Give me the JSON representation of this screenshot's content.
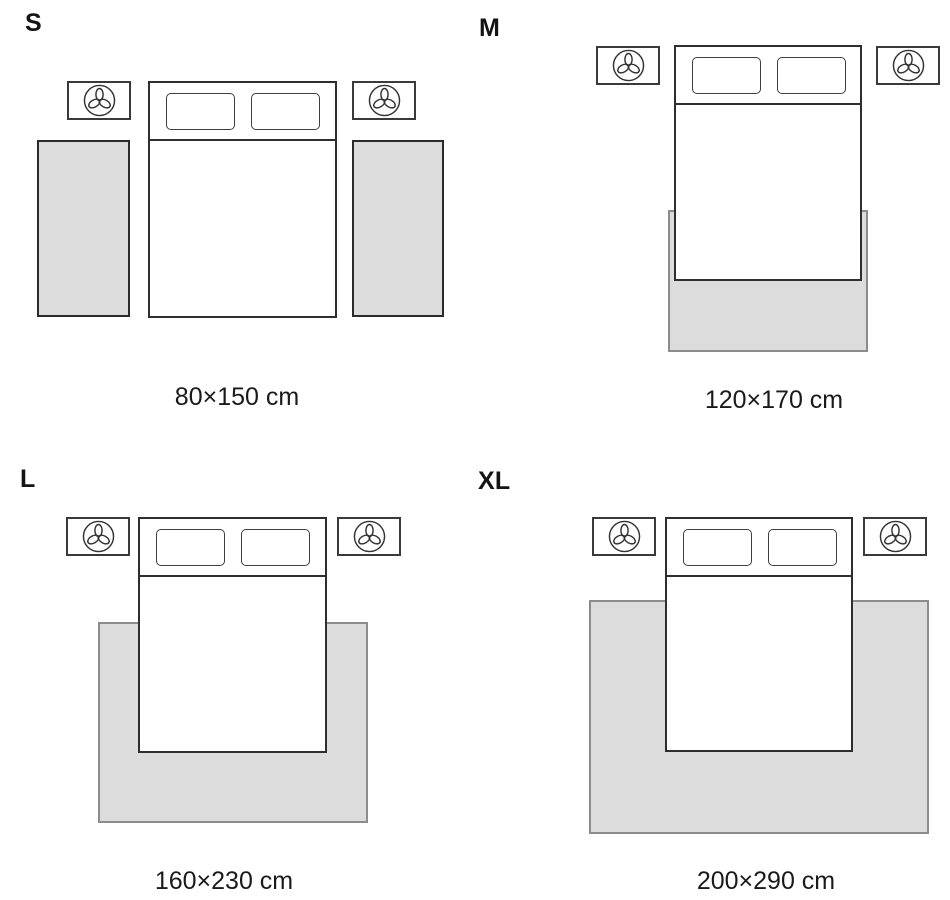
{
  "figure": "rug-size-guide",
  "sizes": [
    {
      "label": "S",
      "dimensions": "80×150 cm",
      "rug_placement": "two runner rugs, one on each side of the bed"
    },
    {
      "label": "M",
      "dimensions": "120×170 cm",
      "rug_placement": "rug under the foot half of the bed"
    },
    {
      "label": "L",
      "dimensions": "160×230 cm",
      "rug_placement": "rug under the bed, extending at both sides and the foot"
    },
    {
      "label": "XL",
      "dimensions": "200×290 cm",
      "rug_placement": "large rug under the bed, extending widely at both sides and the foot"
    }
  ],
  "icons": {
    "nightstand": "plant-icon"
  },
  "colors": {
    "background": "#ffffff",
    "rug_fill": "#dcdcdc",
    "rug_border_standalone": "#2b2b2b",
    "rug_border_under_bed": "#8c8c8c",
    "furniture_outline": "#333333",
    "text": "#161616"
  }
}
